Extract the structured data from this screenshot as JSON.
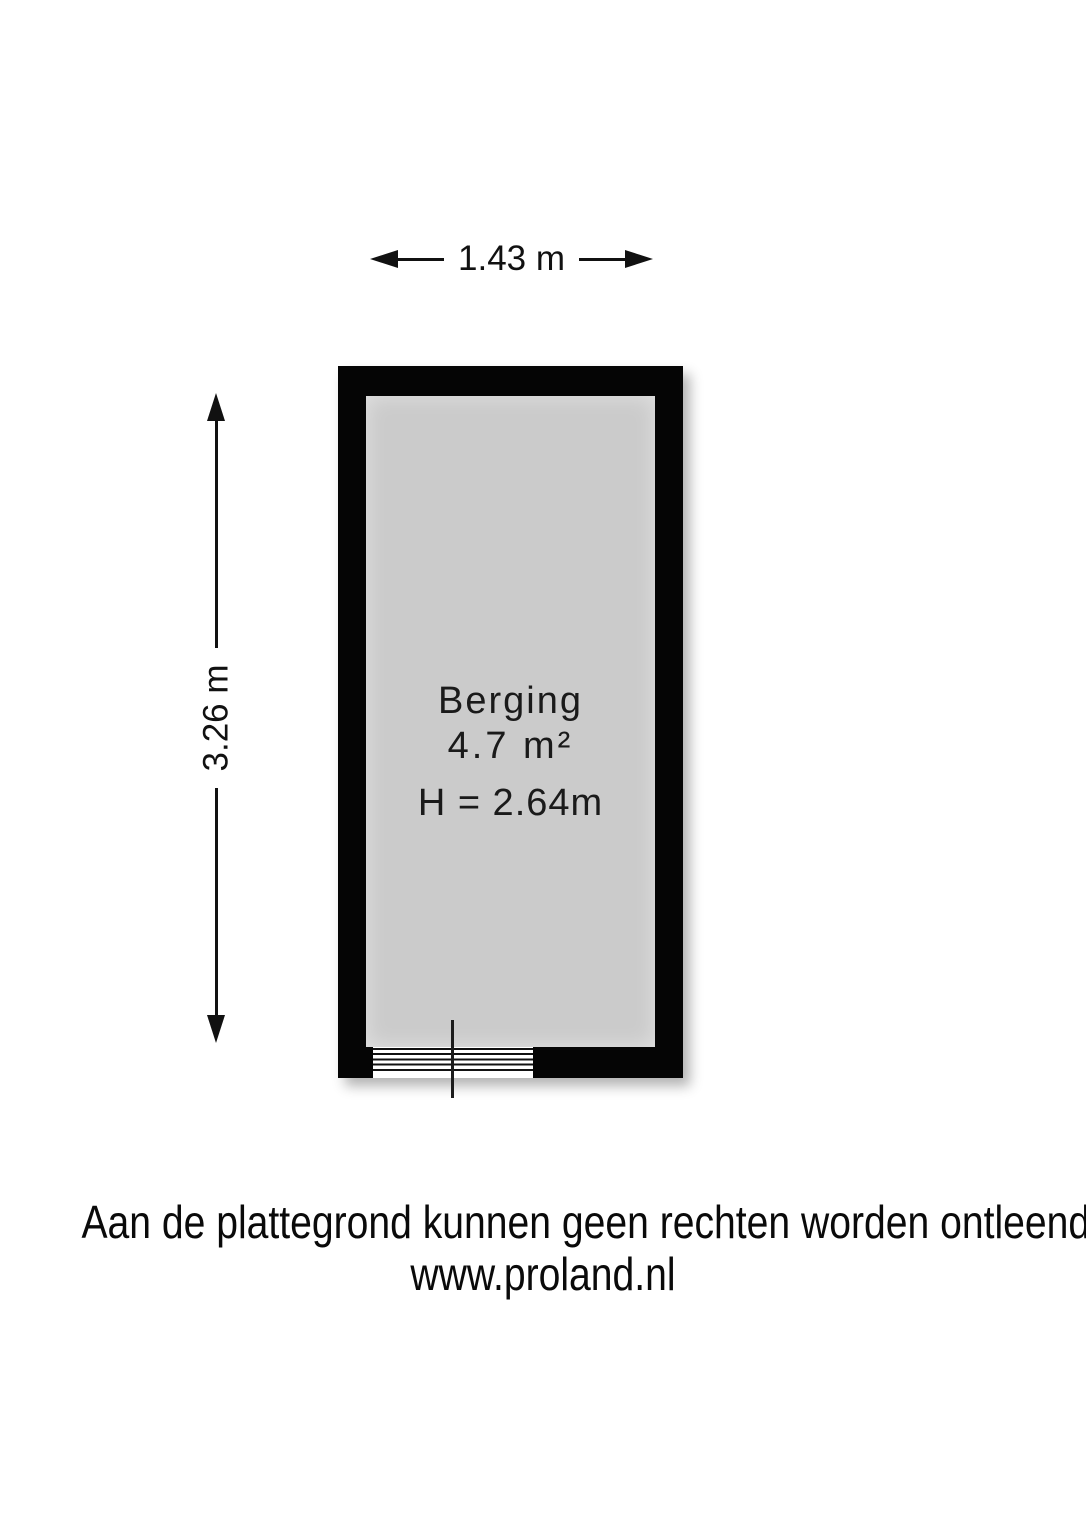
{
  "plan": {
    "room": {
      "name": "Berging",
      "area": "4.7 m²",
      "ceiling_height": "H = 2.64m"
    },
    "dimensions": {
      "width_label": "1.43 m",
      "height_label": "3.26 m"
    },
    "colors": {
      "wall": "#050505",
      "floor": "#cbcbcb",
      "dimension_line": "#111111",
      "background": "#ffffff"
    }
  },
  "footer": {
    "disclaimer": "Aan de plattegrond kunnen geen rechten worden ontleend.",
    "website": "www.proland.nl"
  }
}
